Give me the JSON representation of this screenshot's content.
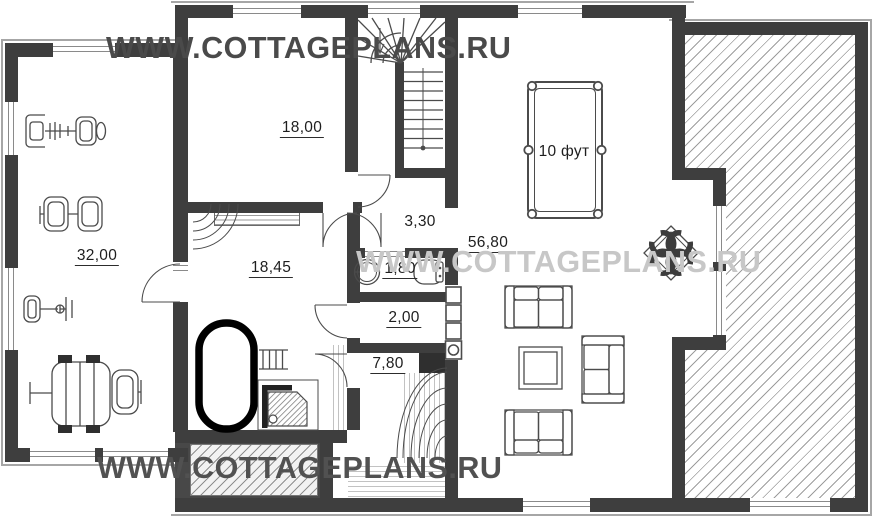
{
  "watermarks": {
    "top": "WWW.COTTAGEPLANS.RU",
    "middle": "WWW.COTTAGEPLANS.RU",
    "bottom": "WWW.COTTAGEPLANS.RU"
  },
  "rooms": {
    "gym": {
      "area": "32,00"
    },
    "room_18": {
      "area": "18,00"
    },
    "bathroom": {
      "area": "18,45"
    },
    "hall": {
      "area": "3,30"
    },
    "wc": {
      "area": "1,80"
    },
    "closet": {
      "area": "2,00"
    },
    "sauna": {
      "area": "7,80"
    },
    "living_room": {
      "area": "56,80"
    }
  },
  "billiard_table": {
    "label": "10 фут"
  },
  "colors": {
    "wall": "#3e3e3e",
    "hatch_line": "#9d9d9d",
    "watermark_dark": "#4a4a4a",
    "watermark_light": "#c7c7c7",
    "tub_outline": "#000000"
  }
}
